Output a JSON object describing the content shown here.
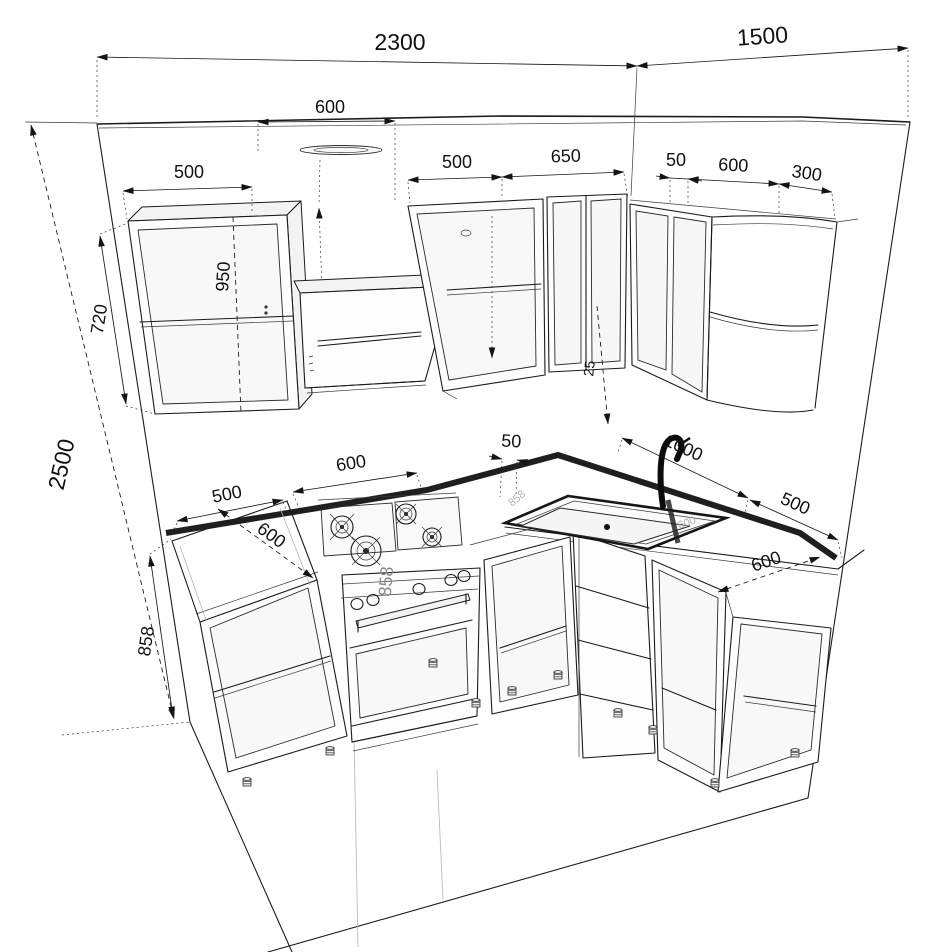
{
  "title": "L-shaped kitchen cabinet set - dimensioned 3D wireframe drawing",
  "units": "mm",
  "style": {
    "line_color": "#1b1b1b",
    "dim_color": "#141414",
    "counter_edge_color": "#1f1f1f",
    "ghost_color": "#b2b2b2",
    "background": "#ffffff"
  },
  "dims": {
    "back_wall_width": {
      "value": "2300",
      "meaning": "width of back wall run"
    },
    "right_wall_width": {
      "value": "1500",
      "meaning": "width of right wall run"
    },
    "room_height": {
      "value": "2500",
      "meaning": "wall height"
    },
    "hood_width": {
      "value": "600",
      "meaning": "range hood width"
    },
    "upper_left_cab_width": {
      "value": "500",
      "meaning": "left wall cabinet width"
    },
    "upper_mid_cab_width": {
      "value": "500",
      "meaning": "open wall cabinet width"
    },
    "upper_mid2_cab_width": {
      "value": "650",
      "meaning": "corner wall cabinet width"
    },
    "upper_corner_gap": {
      "value": "50",
      "meaning": "corner filler"
    },
    "upper_right_cab_width": {
      "value": "600",
      "meaning": "right wall cabinet width"
    },
    "upper_corner_cab_width": {
      "value": "300",
      "meaning": "curved end wall cabinet width"
    },
    "upper_cab_height": {
      "value": "720",
      "meaning": "wall cabinet height"
    },
    "hood_to_counter": {
      "value": "950",
      "meaning": "vertical clearance"
    },
    "corner_offset": {
      "value": "25",
      "meaning": "corner offset"
    },
    "base_cab_height": {
      "value": "858",
      "meaning": "base cabinet height with top"
    },
    "stove_height": {
      "value": "858",
      "meaning": "stove height"
    },
    "base_left_cab_width": {
      "value": "500",
      "meaning": "left base cabinet width"
    },
    "stove_width": {
      "value": "600",
      "meaning": "stove width"
    },
    "base_corner_gap": {
      "value": "50",
      "meaning": "gap stove to corner"
    },
    "sink_run_length": {
      "value": "1000",
      "meaning": "sink run along right wall"
    },
    "base_right_cab_width": {
      "value": "500",
      "meaning": "right base cabinet width"
    },
    "counter_depth_left": {
      "value": "600",
      "meaning": "counter depth left run"
    },
    "counter_depth_right": {
      "value": "600",
      "meaning": "counter depth right run"
    },
    "ghost_height": {
      "value": "858",
      "meaning": "faint hidden dim at corner"
    },
    "ghost_depth": {
      "value": "600",
      "meaning": "faint hidden dim at sink"
    }
  }
}
